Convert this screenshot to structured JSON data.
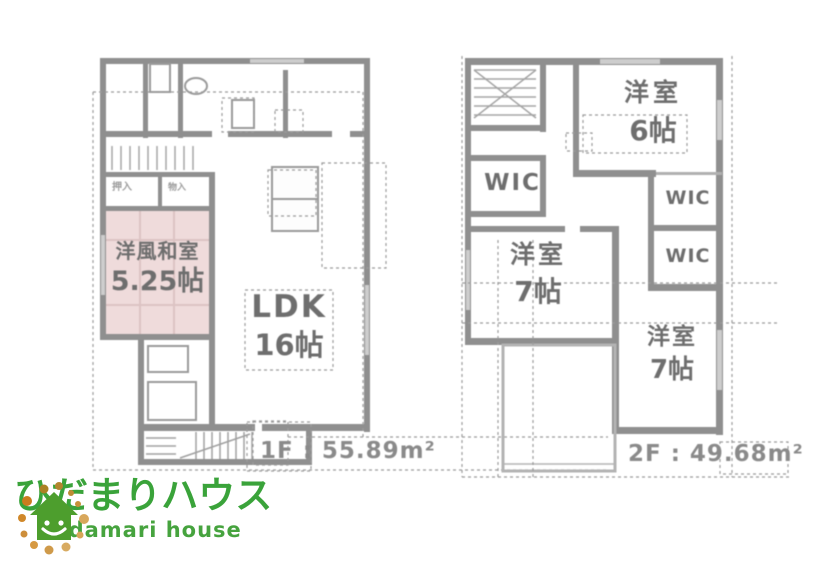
{
  "document": {
    "kind": "real-estate floor plan flyer"
  },
  "floor1": {
    "area_label": "1F : 55.89m²",
    "rooms": [
      {
        "name": "洋風和室",
        "size": "5.25帖"
      },
      {
        "name": "LDK",
        "size": "16帖"
      }
    ],
    "closets": [
      {
        "label": "押入"
      },
      {
        "label": "物入"
      }
    ]
  },
  "floor2": {
    "area_label": "2F : 49.68m²",
    "rooms": [
      {
        "name": "洋室",
        "size": "6帖"
      },
      {
        "name": "WIC"
      },
      {
        "name": "WIC"
      },
      {
        "name": "WIC"
      },
      {
        "name": "洋室",
        "size": "7帖"
      },
      {
        "name": "洋室",
        "size": "7帖"
      }
    ]
  },
  "logo": {
    "title": "ひだまりハウス",
    "subtitle": "hidamari house",
    "colors": {
      "brand_green": "#3aa33a",
      "house_green": "#4d9e2d",
      "dot_orange": "#cc7d1d",
      "dot_tan": "#d9a85c",
      "dot_olive": "#ab8124"
    }
  },
  "palette": {
    "wall_gray": "#8f8f8f",
    "light_wall_gray": "#b3b3b3",
    "room_label_gray": "#6e6e6e",
    "area_label_gray": "#8a8a8a",
    "tatami_pink": "#efdbdb",
    "dash_gray": "#9b9b9b"
  }
}
